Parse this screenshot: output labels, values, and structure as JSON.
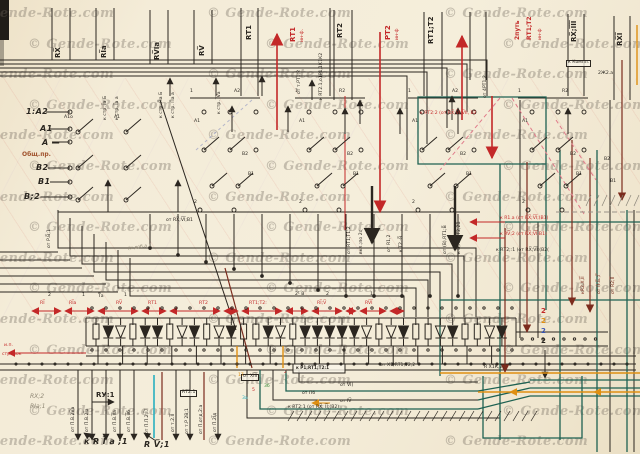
{
  "watermark": {
    "text": "© Gende-Rote.com"
  },
  "top": {
    "black_buses": [
      "RX̅",
      "RI̅а",
      "RV̅Iа",
      "RV̅",
      "RТ1",
      "RТ2",
      "RТ1;Т2",
      "RX̅;I̅I̅I̅",
      "RX̅I̅"
    ],
    "red_buses": {
      "b1": "RТ1",
      "b1s": "ин-ф.",
      "b2": "РТ2",
      "b2s": "ин-ф",
      "b3a": "2путь",
      "b3b": "RТ1;Т2",
      "b3c": "ин-ф"
    },
    "small": {
      "s1": "к RТ2.1,о1Р1,1К1К2",
      "s2": "к стр. I̅а Б",
      "s3": "к стр. I̅а а",
      "s4": "к стр. П̅а Б",
      "s5": "к стр. П̅а а",
      "s6": "к стр. I̅V̅а",
      "s7": "к Компл.",
      "s8": "2Ж2.а",
      "s9": "от т.РТ1;2",
      "s10": "от 4РТ1;2"
    }
  },
  "left": {
    "t1": "1:А2—",
    "t2": "А1 —",
    "t3": "А —",
    "t4": "Общ.пр.",
    "t5": "В2—",
    "t6": "В1—",
    "t7": "В;2—"
  },
  "contacts": {
    "a1o": "А1о",
    "a1": "А1",
    "a2": "А2",
    "r2": "R2",
    "b2": "В2",
    "b1": "В1",
    "n1": "1",
    "n2": "2"
  },
  "mid": {
    "m1": "от RX̅;V̅I̅;В1",
    "m2": "от RТ1;Т1;2",
    "m3": "вкл.;по 2с",
    "m4": "от R1,2",
    "m5": "к Т2,-В̅",
    "m6": "от (В),RТ1;В̅",
    "m7": "к В̅,RТ1;Т2,2В̅",
    "m8": "кR2.Х,I̅I̅",
    "m9": "от П.Б̅.;Г̅",
    "m10": "от R2;I̅I̅",
    "m11": "от Р.В̅;1",
    "r1": "к RТ2:2 (от RX̅;V̅I;V̅II, В2",
    "r2": "к R1.а (от RX̅;V̅I̅;(В1)",
    "r3": "к RV̅;2 (от RX̅;V̅I̅;В1)",
    "k1": "к RТ2;:1 (от RX̅;V̅I̅;(В2(",
    "pencil": "(и доб.а 1"
  },
  "dim": {
    "n1": "2",
    "n2": "1",
    "n3": "Т̅а",
    "n4": "1",
    "n5": "2¹ В",
    "n6": "2",
    "n7": "1",
    "l1": "RI̅",
    "l2": "RI̅а",
    "l3": "RV̅",
    "l4": "RТ1",
    "l5": "RТ2",
    "l6": "RТ1;Т2:",
    "l7": "RI̅;V̅",
    "l8": "RV̅I̅"
  },
  "bottom": {
    "feed1": "и.п.",
    "feed2": "стрелок",
    "w1": "от П.В.2V̅а",
    "w2": "от П.В.2I̅а",
    "w3": "от П.В.I̅I̅а",
    "w4": "от П.В.I̅I̅б",
    "w5": "от П.П.2;I̅7",
    "w6": "от т.2.I̅I̅",
    "w7": "от т.Р 2В;1",
    "w8": "от П.отд.2:а",
    "w9": "от П.2I̅д",
    "h1": "RX;2",
    "h2": "RIа;1",
    "h3": "RУ:1",
    "h4": "RТ2:1",
    "h5": "к R I̅ а ;1",
    "h6": "R V̅;1",
    "n1": "от ХI̅I̅I̅",
    "n2": "от VI̅)",
    "n3": "от Пб",
    "n4": "от IV̅",
    "n5": "к RТ2:1 (от RX̅; I̅I̅;(В2)",
    "n6": "к Р1;RТ1;Т2:1",
    "n7": "от Х1;RТ1;Т2;2",
    "n8": "R̅ Х1̅К,2,",
    "t1": "17",
    "t2": "5",
    "t3": "3а",
    "t4": "3б",
    "t5": "2",
    "s1": "2",
    "s2": "2",
    "s3": "2",
    "s4": "2"
  },
  "diode_row": {
    "pattern": "RDdRDDRdDRdDRRDdRDDDDDdRdDRRdDRRdD"
  }
}
